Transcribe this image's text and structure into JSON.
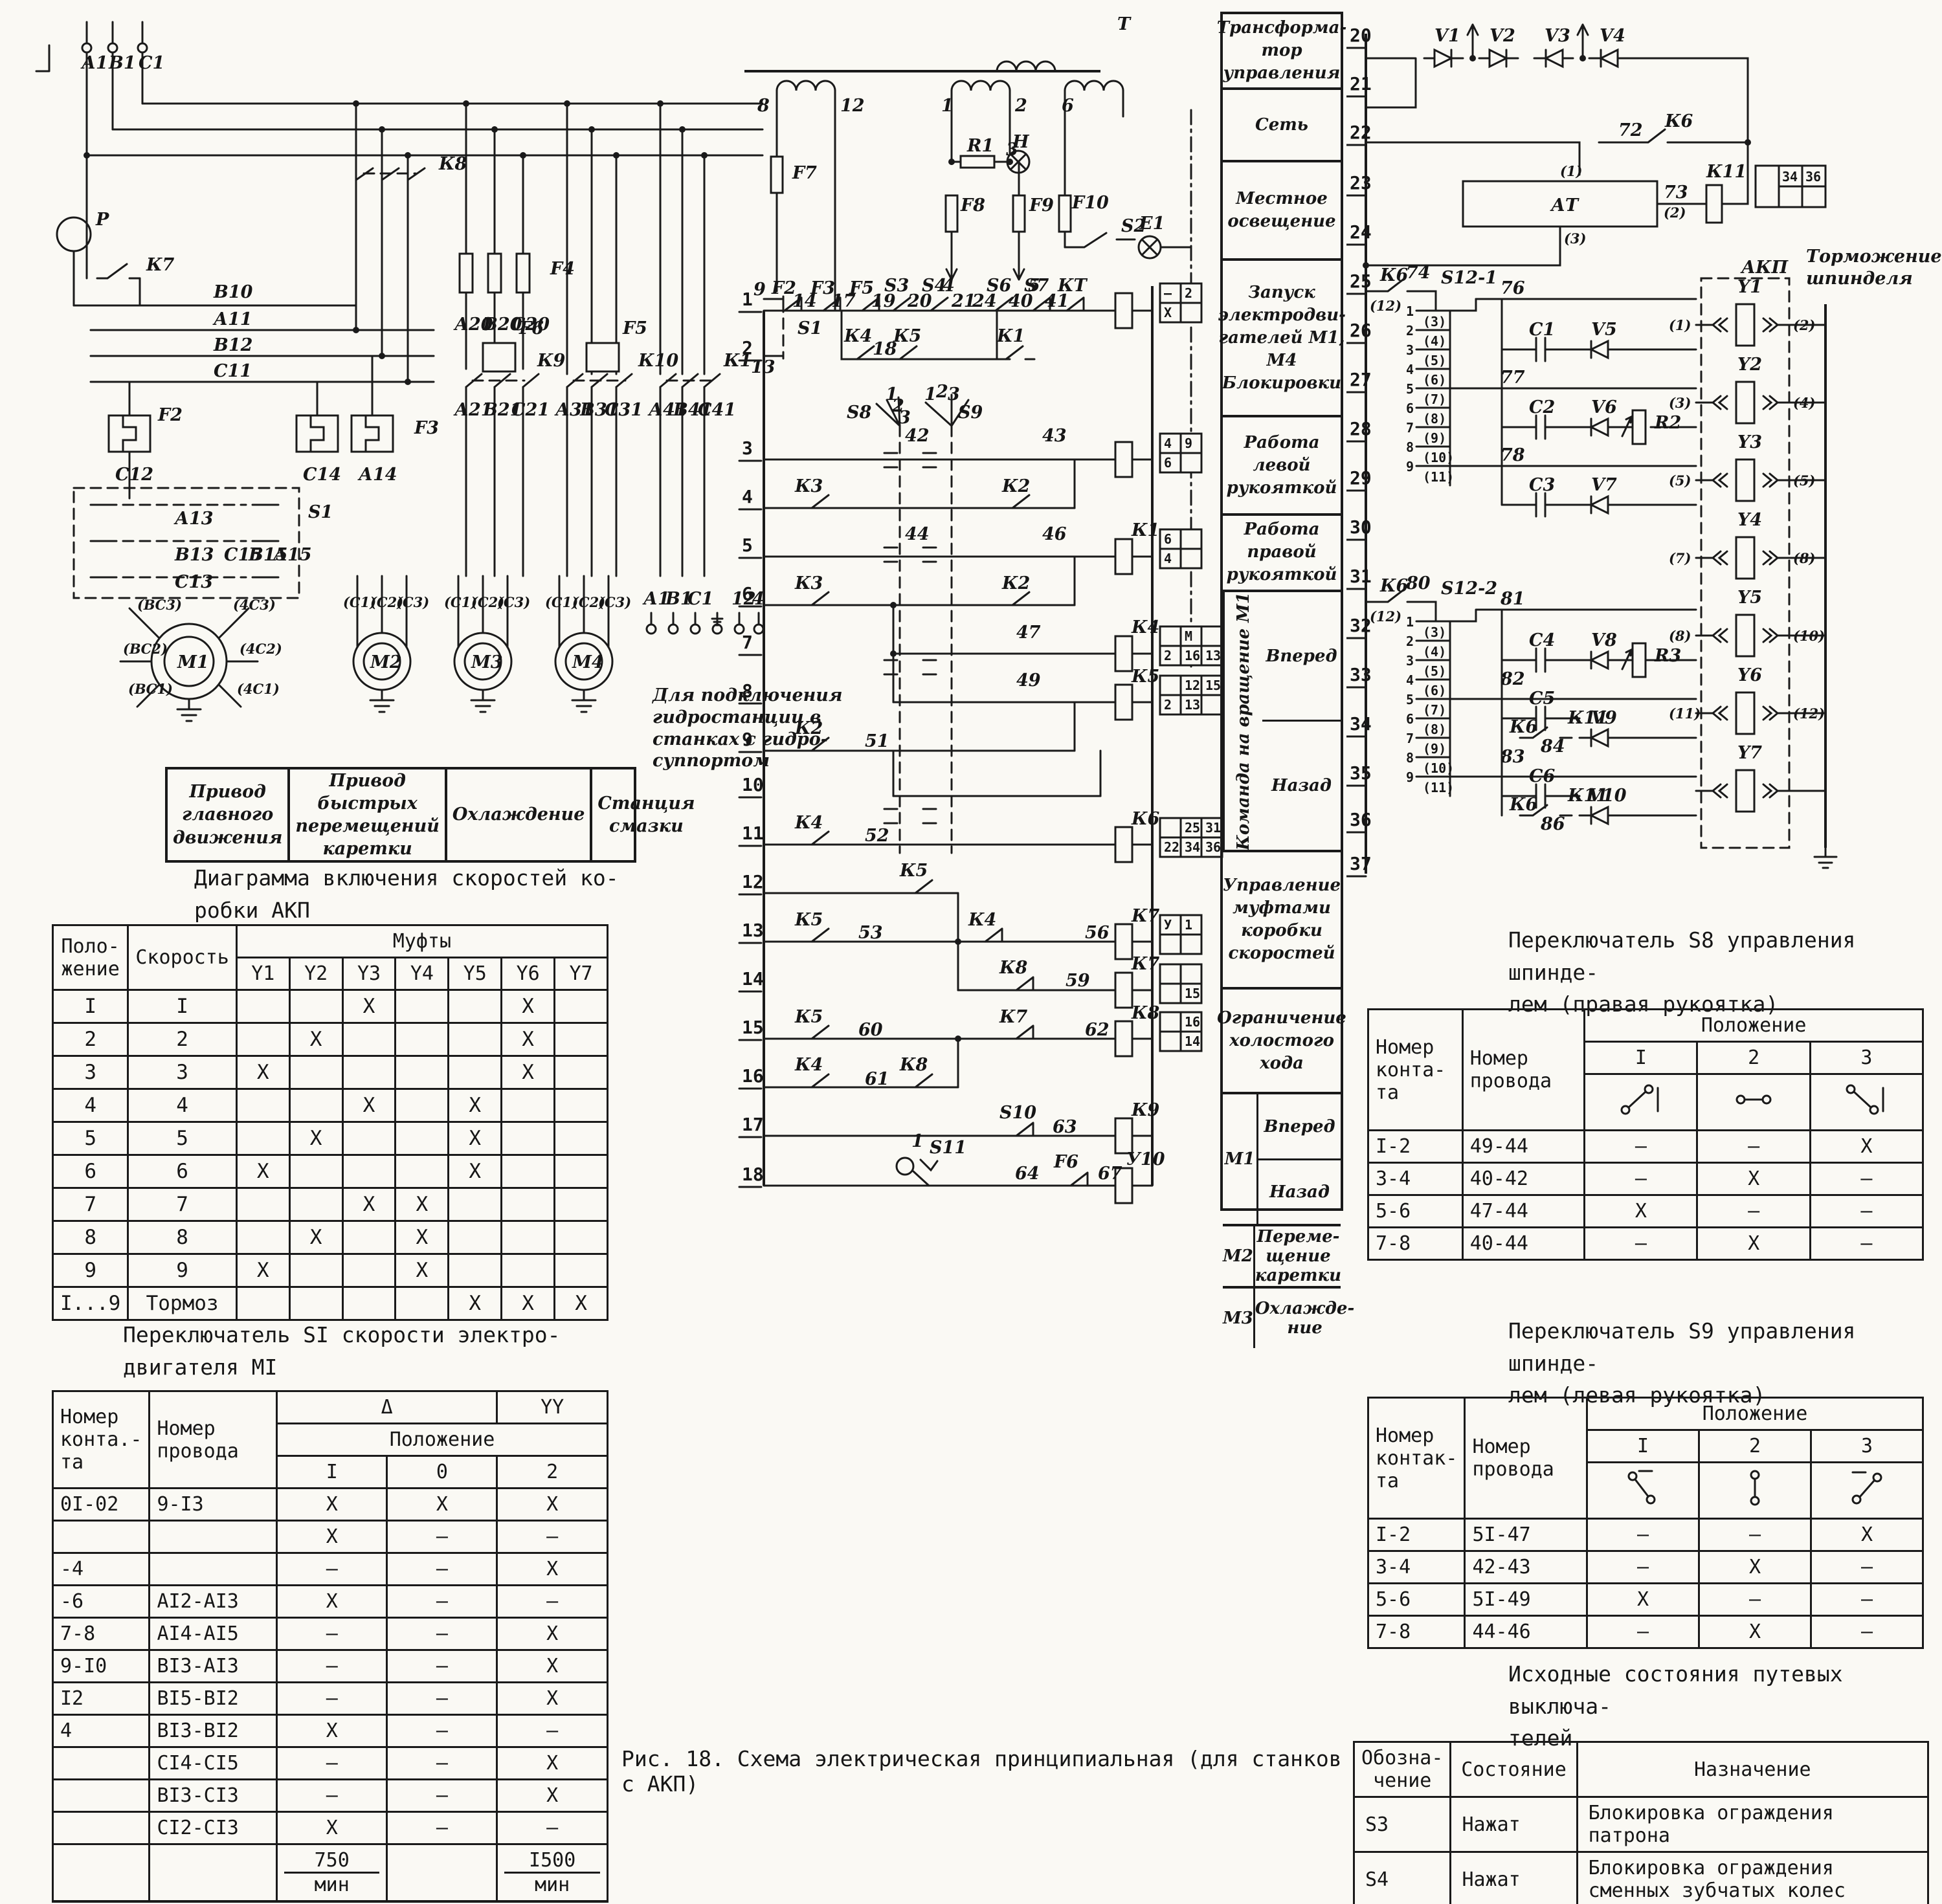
{
  "page": {
    "caption": "Рис. 18. Схема электрическая принципиальная (для станков с АКП)"
  },
  "left_power": {
    "labels": [
      "А1",
      "В1",
      "С1",
      "Р",
      "В10",
      "К7",
      "К8",
      "F4",
      "А20",
      "В20",
      "С20",
      "А11",
      "В12",
      "С11",
      "F2",
      "С12",
      "С14",
      "А14",
      "F3",
      "F6",
      "F5",
      "S1",
      "К9",
      "К10",
      "К1",
      "А13",
      "В13",
      "С13",
      "С15",
      "В15",
      "А15",
      "А21",
      "В21",
      "С21",
      "А31",
      "В31",
      "С31",
      "А41",
      "В41",
      "С41",
      "(ВС3)",
      "(4С3)",
      "(ВС2)",
      "(4С2)",
      "(ВС1)",
      "(4С1)",
      "М1",
      "М2",
      "М3",
      "М4",
      "(С1)",
      "(С2)",
      "(С3)",
      "(С1)",
      "(С2)",
      "(С3)",
      "(С1)",
      "(С2)",
      "(С3)",
      "А1",
      "В1",
      "С1",
      "12",
      "40"
    ],
    "hydro_note": "Для подключения гидростанции в станках с гидро-суппортом",
    "machine_boxes": [
      "Привод главного движения",
      "Привод быстрых перемещений каретки",
      "Охлаждение",
      "Станция смазки"
    ]
  },
  "speed_diagram": {
    "title": "Диаграмма включения скоростей ко-\nробки АКП",
    "header": {
      "position": "Поло-\nжение",
      "speed": "Скорость",
      "clutches": "Муфты"
    },
    "clutch_names": [
      "Y1",
      "Y2",
      "Y3",
      "Y4",
      "Y5",
      "Y6",
      "Y7"
    ],
    "rows": [
      {
        "pos": "I",
        "speed": "I",
        "marks": [
          "",
          "",
          "X",
          "",
          "",
          "X",
          ""
        ]
      },
      {
        "pos": "2",
        "speed": "2",
        "marks": [
          "",
          "X",
          "",
          "",
          "",
          "X",
          ""
        ]
      },
      {
        "pos": "3",
        "speed": "3",
        "marks": [
          "X",
          "",
          "",
          "",
          "",
          "X",
          ""
        ]
      },
      {
        "pos": "4",
        "speed": "4",
        "marks": [
          "",
          "",
          "X",
          "",
          "X",
          "",
          ""
        ]
      },
      {
        "pos": "5",
        "speed": "5",
        "marks": [
          "",
          "X",
          "",
          "",
          "X",
          "",
          ""
        ]
      },
      {
        "pos": "6",
        "speed": "6",
        "marks": [
          "X",
          "",
          "",
          "",
          "X",
          "",
          ""
        ]
      },
      {
        "pos": "7",
        "speed": "7",
        "marks": [
          "",
          "",
          "X",
          "X",
          "",
          "",
          ""
        ]
      },
      {
        "pos": "8",
        "speed": "8",
        "marks": [
          "",
          "X",
          "",
          "X",
          "",
          "",
          ""
        ]
      },
      {
        "pos": "9",
        "speed": "9",
        "marks": [
          "X",
          "",
          "",
          "X",
          "",
          "",
          ""
        ]
      },
      {
        "pos": "I...9",
        "speed": "Тормоз",
        "marks": [
          "",
          "",
          "",
          "",
          "X",
          "X",
          "X"
        ]
      }
    ],
    "caption": "Переключатель  SI скорости электро-\nдвигателя МI"
  },
  "s1_table": {
    "header": {
      "contact": "Номер\nконта.-\nта",
      "wire": "Номер\nпровода",
      "delta": "Δ",
      "yy": "YY",
      "position": "Положение",
      "positions": [
        "I",
        "0",
        "2"
      ]
    },
    "rows": [
      {
        "contact": "0I-02",
        "wire": "9-I3",
        "v": [
          "X",
          "X",
          "X"
        ]
      },
      {
        "contact": "",
        "wire": "",
        "v": [
          "X",
          "–",
          "–"
        ]
      },
      {
        "contact": "-4",
        "wire": "",
        "v": [
          "–",
          "–",
          "X"
        ]
      },
      {
        "contact": "-6",
        "wire": "АI2-АI3",
        "v": [
          "X",
          "–",
          "–"
        ]
      },
      {
        "contact": "7-8",
        "wire": "АI4-АI5",
        "v": [
          "–",
          "–",
          "X"
        ]
      },
      {
        "contact": "9-I0",
        "wire": "ВI3-АI3",
        "v": [
          "–",
          "–",
          "X"
        ]
      },
      {
        "contact": "I2",
        "wire": "ВI5-ВI2",
        "v": [
          "–",
          "–",
          "X"
        ]
      },
      {
        "contact": "4",
        "wire": "ВI3-ВI2",
        "v": [
          "X",
          "–",
          "–"
        ]
      },
      {
        "contact": "",
        "wire": "СI4-СI5",
        "v": [
          "–",
          "–",
          "X"
        ]
      },
      {
        "contact": "",
        "wire": "ВI3-СI3",
        "v": [
          "–",
          "–",
          "X"
        ]
      },
      {
        "contact": "",
        "wire": "СI2-СI3",
        "v": [
          "X",
          "–",
          "–"
        ]
      }
    ],
    "footer": {
      "delta_value": "750",
      "delta_unit": "мин",
      "yy_value": "I500",
      "yy_unit": "мин"
    }
  },
  "ladder": {
    "labels": [
      "Т",
      "8",
      "12",
      "1",
      "2",
      "6",
      "F7",
      "R1",
      "3",
      "Н",
      "F8",
      "F9",
      "F10",
      "S2",
      "Е1",
      "4",
      "5",
      "9",
      "S1",
      "13",
      "F2",
      "14",
      "F3",
      "17",
      "F5",
      "S3",
      "19",
      "S4",
      "20",
      "21",
      "S6",
      "24",
      "S7",
      "40",
      "КТ",
      "41",
      "К4",
      "18",
      "К5",
      "К1",
      "S8",
      "1",
      "2",
      "3",
      "1",
      "2",
      "3",
      "S9",
      "42",
      "43",
      "К3",
      "К2",
      "44",
      "46",
      "К1",
      "К3",
      "К2",
      "47",
      "К4",
      "49",
      "К5",
      "К2",
      "51",
      "К4",
      "52",
      "К6",
      "К5",
      "К5",
      "53",
      "К4",
      "56",
      "К7",
      "К8",
      "59",
      "К7",
      "К5",
      "60",
      "К7",
      "62",
      "К8",
      "К4",
      "61",
      "К8",
      "S10",
      "63",
      "К9",
      "S11",
      "1",
      "64",
      "F6",
      "67",
      "У10"
    ],
    "rung_numbers": [
      "1",
      "2",
      "3",
      "4",
      "5",
      "6",
      "7",
      "8",
      "9",
      "10",
      "11",
      "12",
      "13",
      "14",
      "15",
      "16",
      "17",
      "18"
    ],
    "refboxes": [
      [
        "–",
        "2",
        "X",
        ""
      ],
      [
        "4",
        "9",
        "6",
        ""
      ],
      [
        "6",
        "",
        "4",
        ""
      ],
      [
        "",
        "М",
        "",
        "2",
        "16",
        "13"
      ],
      [
        "",
        "12",
        "15",
        "2",
        "13",
        ""
      ],
      [
        "",
        "25",
        "31",
        "22",
        "34",
        "36"
      ],
      [
        "У",
        "1",
        "",
        ""
      ],
      [
        "",
        "",
        "",
        "15"
      ],
      [
        "",
        "16",
        "",
        "14"
      ]
    ]
  },
  "function_column": {
    "simple_top": [
      "Трансформа-тор управления",
      "Сеть",
      "Местное освещение",
      "Запуск электродви-гателей М1, М4 Блокировки",
      "Работа левой рукояткой",
      "Работа правой рукояткой"
    ],
    "command_group": {
      "side": "Команда на вращение М1",
      "items": [
        "Вперед",
        "Назад"
      ]
    },
    "middle": [
      "Управление муфтами коробки скоростей",
      "Ограничение холостого хода"
    ],
    "motor_groups": [
      {
        "motor": "М1",
        "items": [
          "Вперед",
          "Назад"
        ]
      },
      {
        "motor": "М2",
        "items": [
          "Переме-щение каретки"
        ]
      },
      {
        "motor": "М3",
        "items": [
          "Охлажде-ние"
        ]
      }
    ]
  },
  "right_circuit": {
    "labels": [
      "V1",
      "V2",
      "V3",
      "V4",
      "72",
      "К6",
      "(1)",
      "АТ",
      "73",
      "(2)",
      "(3)",
      "К11",
      "К6",
      "74",
      "(12)",
      "S12-1",
      "76",
      "77",
      "78",
      "С1",
      "V5",
      "С2",
      "V6",
      "R2",
      "С3",
      "V7",
      "Y1",
      "(1)",
      "(2)",
      "Y2",
      "(3)",
      "(4)",
      "Y3",
      "(5)",
      "(5)",
      "Y4",
      "(7)",
      "(8)",
      "К6",
      "80",
      "(12)",
      "S12-2",
      "81",
      "82",
      "83",
      "С4",
      "V8",
      "R3",
      "С5",
      "К6",
      "84",
      "К11",
      "V9",
      "С6",
      "К6",
      "86",
      "К11",
      "V10",
      "Y5",
      "(8)",
      "(10)",
      "Y6",
      "(11)",
      "(12)",
      "Y7"
    ],
    "line_numbers": [
      "20",
      "21",
      "22",
      "23",
      "24",
      "25",
      "26",
      "27",
      "28",
      "29",
      "30",
      "31",
      "32",
      "33",
      "34",
      "35",
      "36",
      "37"
    ],
    "s12_contacts": [
      "1",
      "2",
      "3",
      "4",
      "5",
      "6",
      "7",
      "8",
      "9"
    ],
    "s12_terms": [
      "(3)",
      "(4)",
      "(5)",
      "(6)",
      "(7)",
      "(8)",
      "(9)",
      "(10)",
      "(11)"
    ],
    "akp_label": "АКП",
    "brake_label": "Торможение шпинделя",
    "kt_box": [
      "34",
      "36"
    ]
  },
  "s8_table": {
    "title": "Переключатель  S8 управления шпинде-\nлем (правая рукоятка)",
    "header": {
      "contact": "Номер\nконта-\nта",
      "wire": "Номер\nпровода",
      "position": "Положение",
      "positions": [
        "I",
        "2",
        "3"
      ]
    },
    "rows": [
      {
        "contact": "I-2",
        "wire": "49-44",
        "v": [
          "–",
          "–",
          "X"
        ]
      },
      {
        "contact": "3-4",
        "wire": "40-42",
        "v": [
          "–",
          "X",
          "–"
        ]
      },
      {
        "contact": "5-6",
        "wire": "47-44",
        "v": [
          "X",
          "–",
          "–"
        ]
      },
      {
        "contact": "7-8",
        "wire": "40-44",
        "v": [
          "–",
          "X",
          "–"
        ]
      }
    ]
  },
  "s9_table": {
    "title": "Переключатель  S9 управления шпинде-\nлем (левая рукоятка)",
    "header": {
      "contact": "Номер\nконтак-\nта",
      "wire": "Номер\nпровода",
      "position": "Положение",
      "positions": [
        "I",
        "2",
        "3"
      ]
    },
    "rows": [
      {
        "contact": "I-2",
        "wire": "5I-47",
        "v": [
          "–",
          "–",
          "X"
        ]
      },
      {
        "contact": "3-4",
        "wire": "42-43",
        "v": [
          "–",
          "X",
          "–"
        ]
      },
      {
        "contact": "5-6",
        "wire": "5I-49",
        "v": [
          "X",
          "–",
          "–"
        ]
      },
      {
        "contact": "7-8",
        "wire": "44-46",
        "v": [
          "–",
          "X",
          "–"
        ]
      }
    ]
  },
  "limit_switches": {
    "title": "Исходные состояния путевых выключа-\nтелей",
    "header": {
      "sign": "Обозна-\nчение",
      "state": "Состояние",
      "purpose": "Назначение"
    },
    "rows": [
      {
        "sign": "S3",
        "state": "Нажат",
        "purpose": "Блокировка ограждения патрона"
      },
      {
        "sign": "S4",
        "state": "Нажат",
        "purpose": "Блокировка ограждения сменных зубчатых колес"
      }
    ]
  }
}
